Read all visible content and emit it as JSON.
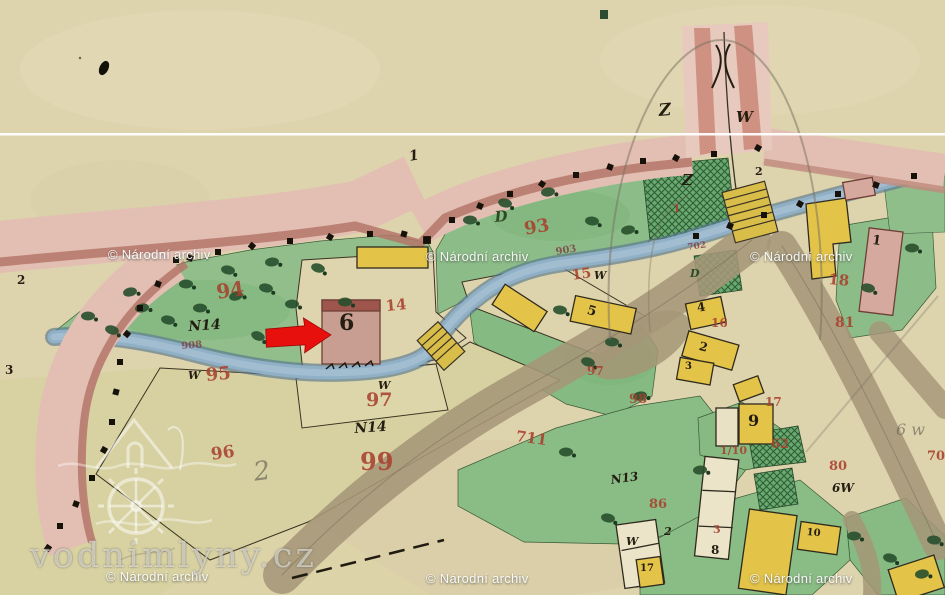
{
  "map_type": "historic cadastral watercolor map",
  "colors": {
    "paper": "#ddd3ad",
    "road_pink": "#e2bfb2",
    "road_edge_dark": "#b5766a",
    "stream_blue": "#8fb0c6",
    "meadow_green": "#8fbe8a",
    "tree_green": "#274f2c",
    "building_yellow": "#e3c348",
    "building_pink": "#c99e92",
    "road_brown": "#a59677",
    "arrow_red": "#e8100c",
    "watermark_white": "#ffffff"
  },
  "watermarks": {
    "text": "© Národní archiv",
    "positions": [
      [
        108,
        248
      ],
      [
        426,
        250
      ],
      [
        750,
        250
      ],
      [
        106,
        570
      ],
      [
        426,
        572
      ],
      [
        750,
        572
      ]
    ]
  },
  "logo": {
    "text": "vodnimlyny.cz"
  },
  "arrow": {
    "points_to": "6",
    "color": "#e8100c"
  },
  "labels": [
    {
      "t": "94",
      "x": 215,
      "y": 282,
      "s": 20,
      "c": "red",
      "r": -8
    },
    {
      "t": "95",
      "x": 205,
      "y": 367,
      "s": 18,
      "c": "red",
      "r": -5
    },
    {
      "t": "96",
      "x": 210,
      "y": 447,
      "s": 17,
      "c": "red",
      "r": -8
    },
    {
      "t": "97",
      "x": 366,
      "y": 391,
      "s": 19,
      "c": "red",
      "r": 0
    },
    {
      "t": "99",
      "x": 360,
      "y": 450,
      "s": 24,
      "c": "red",
      "r": 0
    },
    {
      "t": "93",
      "x": 523,
      "y": 221,
      "s": 18,
      "c": "red",
      "r": -10
    },
    {
      "t": "14",
      "x": 385,
      "y": 299,
      "s": 15,
      "c": "red",
      "r": -5
    },
    {
      "t": "15",
      "x": 571,
      "y": 269,
      "s": 14,
      "c": "red",
      "r": -8
    },
    {
      "t": "97",
      "x": 587,
      "y": 365,
      "s": 12,
      "c": "red",
      "r": 0
    },
    {
      "t": "98",
      "x": 629,
      "y": 393,
      "s": 13,
      "c": "red",
      "r": 0
    },
    {
      "t": "711",
      "x": 517,
      "y": 429,
      "s": 15,
      "c": "red",
      "r": 8
    },
    {
      "t": "16",
      "x": 711,
      "y": 317,
      "s": 12,
      "c": "red",
      "r": 0
    },
    {
      "t": "18",
      "x": 829,
      "y": 272,
      "s": 15,
      "c": "red",
      "r": 5
    },
    {
      "t": "81",
      "x": 835,
      "y": 316,
      "s": 14,
      "c": "red",
      "r": 0
    },
    {
      "t": "17",
      "x": 765,
      "y": 396,
      "s": 12,
      "c": "red",
      "r": 0
    },
    {
      "t": "1/10",
      "x": 720,
      "y": 445,
      "s": 11,
      "c": "red",
      "r": 0
    },
    {
      "t": "62",
      "x": 771,
      "y": 438,
      "s": 13,
      "c": "red",
      "r": 0
    },
    {
      "t": "80",
      "x": 829,
      "y": 460,
      "s": 13,
      "c": "red",
      "r": 0
    },
    {
      "t": "86",
      "x": 649,
      "y": 498,
      "s": 13,
      "c": "red",
      "r": 0
    },
    {
      "t": "3",
      "x": 713,
      "y": 524,
      "s": 11,
      "c": "red",
      "r": 0
    },
    {
      "t": "70",
      "x": 927,
      "y": 450,
      "s": 13,
      "c": "red",
      "r": 0
    },
    {
      "t": "1",
      "x": 673,
      "y": 203,
      "s": 11,
      "c": "red",
      "r": 0
    },
    {
      "t": "908",
      "x": 181,
      "y": 342,
      "s": 10,
      "c": "streamnum",
      "r": -4
    },
    {
      "t": "903",
      "x": 555,
      "y": 248,
      "s": 10,
      "c": "streamnum",
      "r": -10
    },
    {
      "t": "702",
      "x": 687,
      "y": 244,
      "s": 9,
      "c": "streamnum",
      "r": -8
    },
    {
      "t": "6",
      "x": 339,
      "y": 312,
      "s": 22,
      "c": "ink",
      "r": 0
    },
    {
      "t": "5",
      "x": 589,
      "y": 304,
      "s": 13,
      "c": "ink",
      "r": 15
    },
    {
      "t": "4",
      "x": 696,
      "y": 302,
      "s": 12,
      "c": "ink",
      "r": -10
    },
    {
      "t": "2",
      "x": 701,
      "y": 340,
      "s": 12,
      "c": "ink",
      "r": 15
    },
    {
      "t": "3",
      "x": 685,
      "y": 362,
      "s": 10,
      "c": "ink",
      "r": 0
    },
    {
      "t": "9",
      "x": 748,
      "y": 413,
      "s": 16,
      "c": "ink",
      "r": 0
    },
    {
      "t": "8",
      "x": 711,
      "y": 544,
      "s": 12,
      "c": "ink",
      "r": 0
    },
    {
      "t": "10",
      "x": 807,
      "y": 528,
      "s": 10,
      "c": "ink",
      "r": 5
    },
    {
      "t": "17",
      "x": 640,
      "y": 564,
      "s": 10,
      "c": "ink",
      "r": 0
    },
    {
      "t": "1",
      "x": 873,
      "y": 234,
      "s": 13,
      "c": "ink",
      "r": 8
    },
    {
      "t": "2",
      "x": 17,
      "y": 274,
      "s": 12,
      "c": "ink",
      "r": 0
    },
    {
      "t": "3",
      "x": 5,
      "y": 364,
      "s": 12,
      "c": "ink",
      "r": 0
    },
    {
      "t": "2",
      "x": 755,
      "y": 166,
      "s": 11,
      "c": "ink",
      "r": 0
    },
    {
      "t": "Z",
      "x": 658,
      "y": 103,
      "s": 17,
      "c": "script",
      "r": -5
    },
    {
      "t": "W",
      "x": 736,
      "y": 110,
      "s": 15,
      "c": "script",
      "r": 0
    },
    {
      "t": "Z",
      "x": 682,
      "y": 173,
      "s": 15,
      "c": "script",
      "r": 0
    },
    {
      "t": "D",
      "x": 494,
      "y": 210,
      "s": 15,
      "c": "green",
      "r": -5
    },
    {
      "t": "D",
      "x": 690,
      "y": 268,
      "s": 11,
      "c": "green",
      "r": 0
    },
    {
      "t": "N14",
      "x": 188,
      "y": 320,
      "s": 14,
      "c": "script",
      "r": -4
    },
    {
      "t": "N14",
      "x": 354,
      "y": 422,
      "s": 14,
      "c": "script",
      "r": -4
    },
    {
      "t": "N13",
      "x": 610,
      "y": 474,
      "s": 12,
      "c": "script",
      "r": -8
    },
    {
      "t": "1",
      "x": 408,
      "y": 150,
      "s": 14,
      "c": "script",
      "r": -10
    },
    {
      "t": "W",
      "x": 378,
      "y": 380,
      "s": 11,
      "c": "script",
      "r": 0
    },
    {
      "t": "W",
      "x": 188,
      "y": 370,
      "s": 11,
      "c": "script",
      "r": 0
    },
    {
      "t": "W",
      "x": 594,
      "y": 270,
      "s": 11,
      "c": "script",
      "r": 0
    },
    {
      "t": "W",
      "x": 626,
      "y": 536,
      "s": 11,
      "c": "script",
      "r": 0
    },
    {
      "t": "2",
      "x": 664,
      "y": 526,
      "s": 11,
      "c": "script",
      "r": 0
    },
    {
      "t": "6W",
      "x": 832,
      "y": 482,
      "s": 12,
      "c": "script",
      "r": 0
    },
    {
      "t": "6 w",
      "x": 896,
      "y": 422,
      "s": 16,
      "c": "pencil",
      "r": 0
    },
    {
      "t": "2",
      "x": 252,
      "y": 460,
      "s": 26,
      "c": "pencil",
      "r": -8
    }
  ]
}
